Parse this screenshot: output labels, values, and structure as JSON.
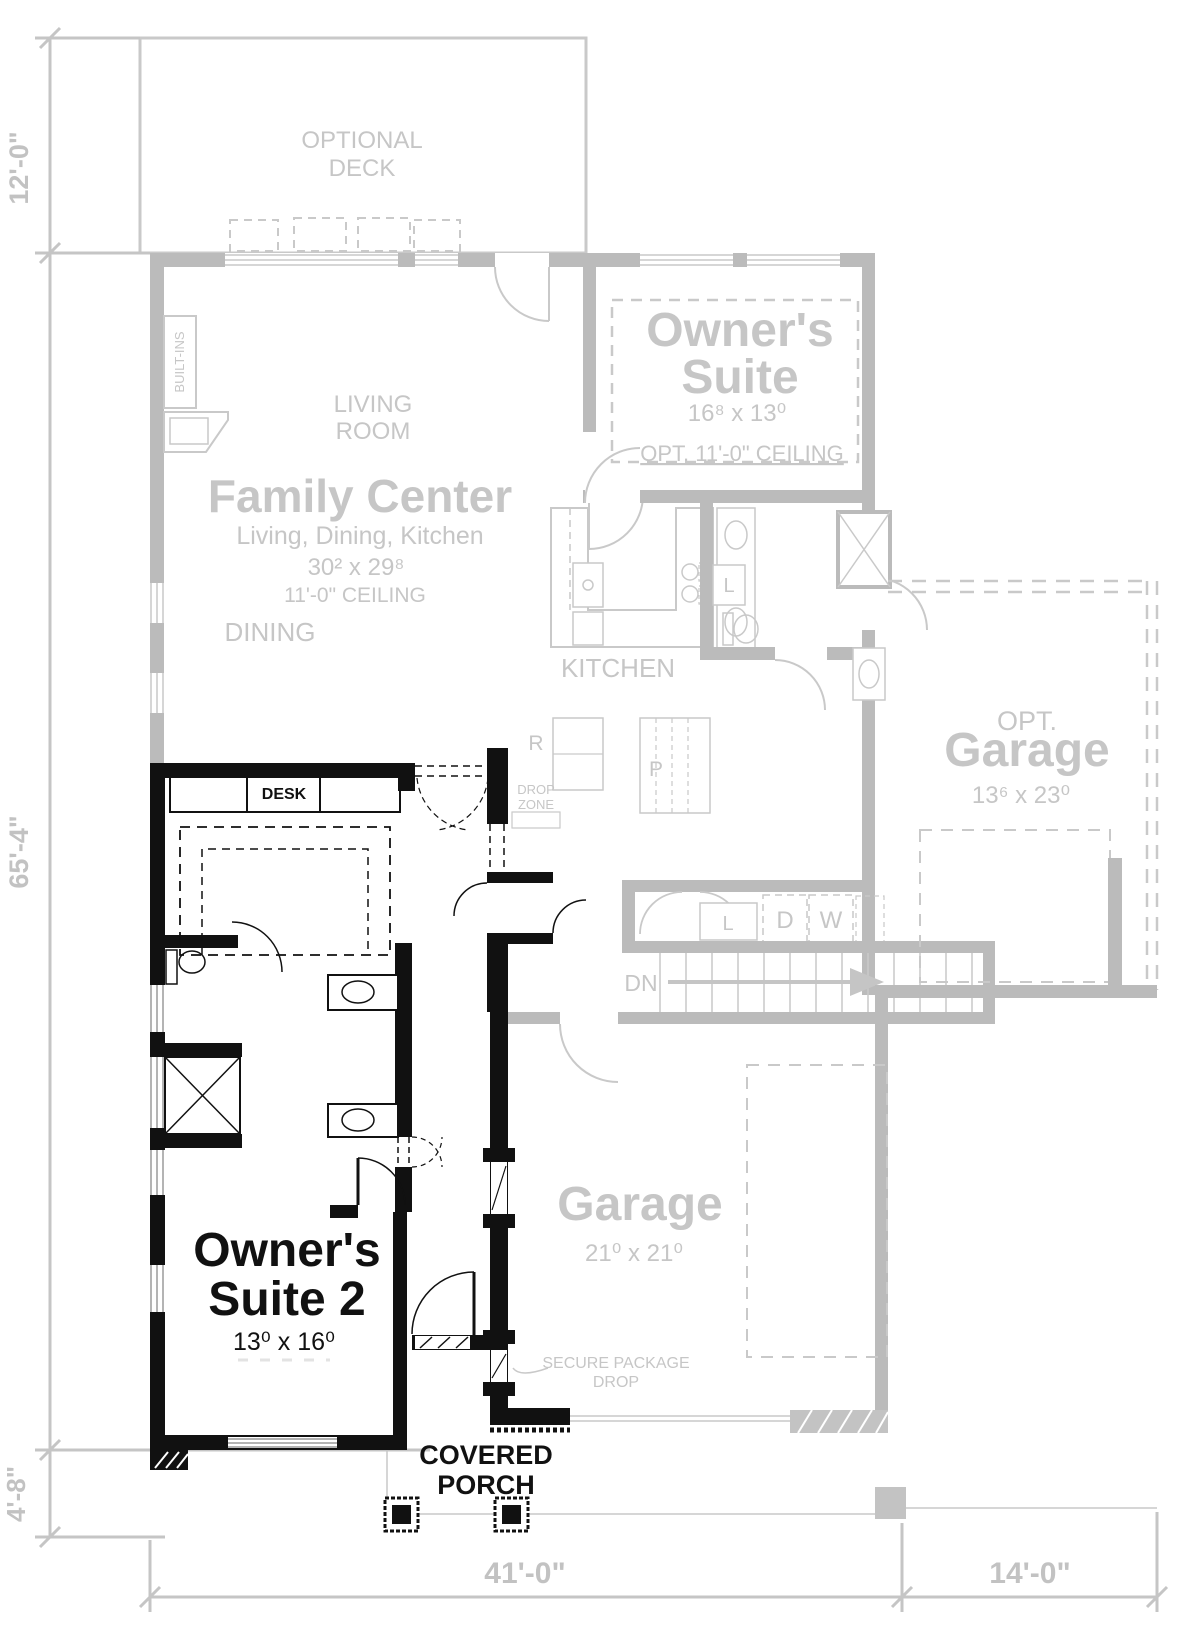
{
  "plan": {
    "dimensions": {
      "left_top": "12'-0\"",
      "left_main": "65'-4\"",
      "left_bottom": "4'-8\"",
      "bottom_main": "41'-0\"",
      "bottom_right": "14'-0\""
    },
    "rooms": {
      "optional_deck": {
        "line1": "OPTIONAL",
        "line2": "DECK"
      },
      "living_room": {
        "line1": "LIVING",
        "line2": "ROOM"
      },
      "family_center": {
        "title": "Family Center",
        "subtitle": "Living, Dining, Kitchen",
        "dims": "30² x 29⁸",
        "ceiling": "11'-0\" CEILING"
      },
      "dining": {
        "label": "DINING"
      },
      "kitchen": {
        "label": "KITCHEN"
      },
      "owners_suite": {
        "line1": "Owner's",
        "line2": "Suite",
        "dims": "16⁸ x 13⁰",
        "ceiling": "OPT. 11'-0\" CEILING"
      },
      "opt_garage": {
        "line1": "OPT.",
        "line2": "Garage",
        "dims": "13⁶ x 23⁰"
      },
      "garage": {
        "title": "Garage",
        "dims": "21⁰ x 21⁰"
      },
      "owners_suite_2": {
        "line1": "Owner's",
        "line2": "Suite 2",
        "dims": "13⁰ x 16⁰"
      },
      "covered_porch": {
        "line1": "COVERED",
        "line2": "PORCH"
      }
    },
    "annotations": {
      "built_ins": "BUILT-INS",
      "desk": "DESK",
      "drop_zone_line1": "DROP",
      "drop_zone_line2": "ZONE",
      "fridge": "R",
      "pantry": "P",
      "linen": "L",
      "closet": "L",
      "dryer": "D",
      "washer": "W",
      "stairs_down": "DN",
      "secure_package_line1": "SECURE PACKAGE",
      "secure_package_line2": "DROP"
    },
    "colors": {
      "existing_lines": "#c9c9c9",
      "existing_walls": "#bbbbbb",
      "existing_text": "#c6c6c6",
      "new_walls": "#111111",
      "dim_text": "#c2c2c2"
    }
  }
}
